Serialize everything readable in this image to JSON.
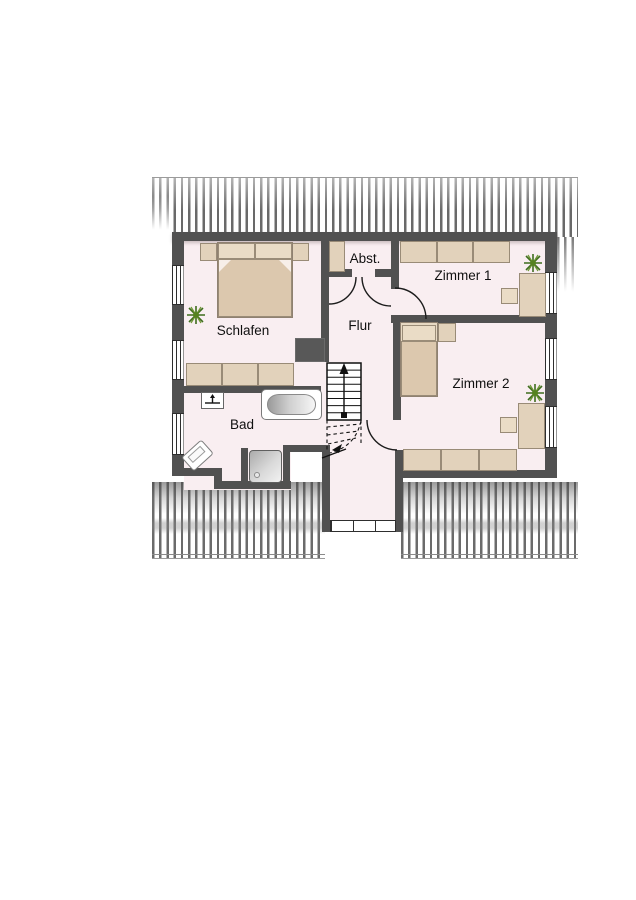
{
  "rooms": [
    {
      "name": "schlafen",
      "label": "Schlafen"
    },
    {
      "name": "bad",
      "label": "Bad"
    },
    {
      "name": "flur",
      "label": "Flur"
    },
    {
      "name": "abstellraum",
      "label": "Abst."
    },
    {
      "name": "zimmer1",
      "label": "Zimmer 1"
    },
    {
      "name": "zimmer2",
      "label": "Zimmer 2"
    }
  ],
  "colors": {
    "wall": "#515151",
    "floor": "#f9eef1",
    "furniture": "#e2d2bb",
    "furniture_border": "#998b77",
    "plant_green": "#4e7a1e",
    "roof_hatch_line": "#6b6b6b"
  },
  "icons": {
    "plant": "starburst-plant",
    "stairs_direction": "up-arrow",
    "toilet": "wc-basin-symbol",
    "bathtub": "oval-tub",
    "shower": "square-tray-with-drain",
    "sink": "tilted-basin"
  }
}
